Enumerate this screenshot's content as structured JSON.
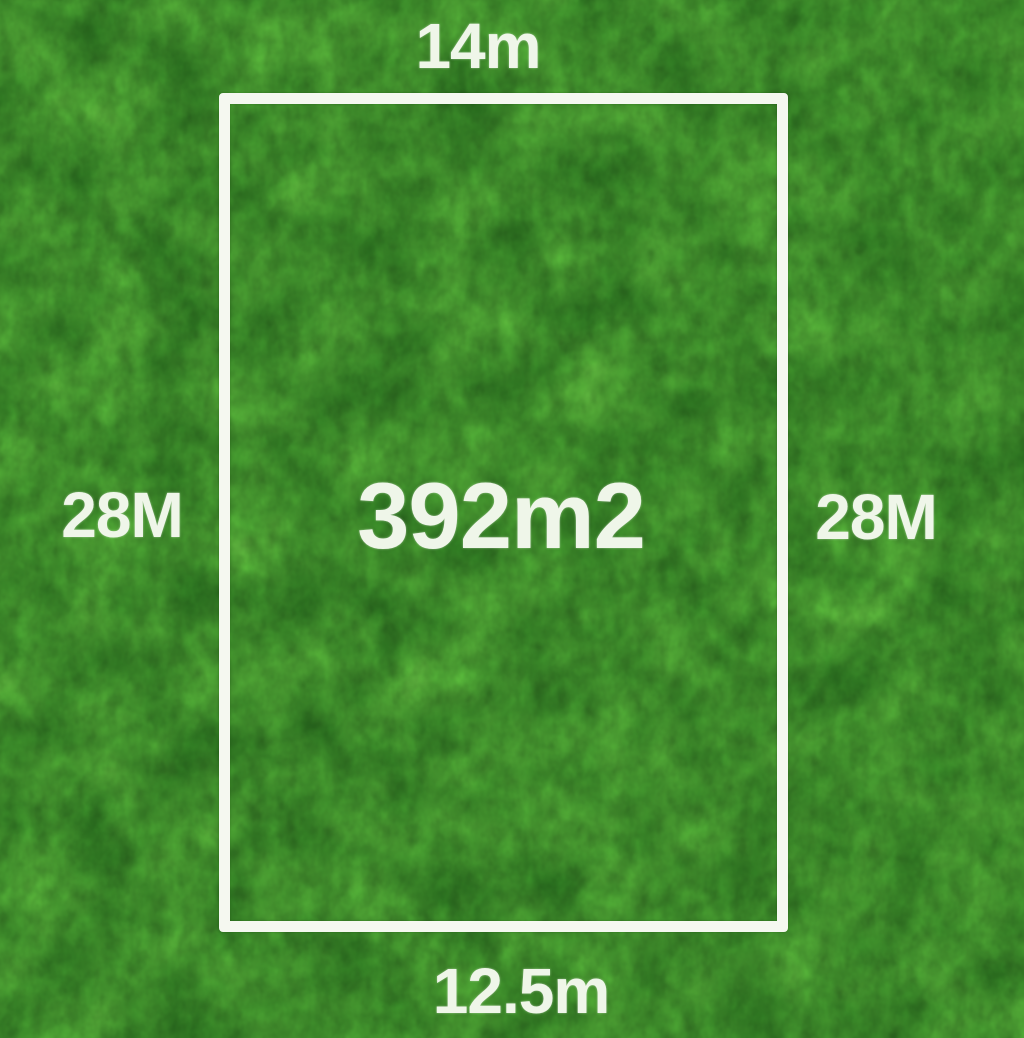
{
  "scene": {
    "description": "Residential land lot dimension diagram drawn over a grass texture",
    "grass_color_dark": "#2e6b22",
    "grass_color_mid": "#4a8f33",
    "grass_color_light": "#79b65a",
    "boundary_color": "#f5f8f0",
    "label_color": "#eff6e9"
  },
  "plot": {
    "area_label": "392m2",
    "top_width_label": "14m",
    "bottom_width_label": "12.5m",
    "left_depth_label": "28M",
    "right_depth_label": "28M"
  }
}
